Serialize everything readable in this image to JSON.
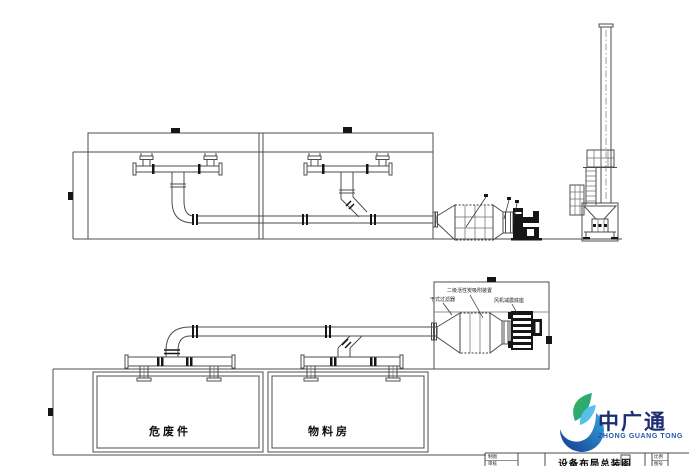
{
  "labels": {
    "room_left": "危废件",
    "room_right": "物料房",
    "plan_filter": "干式过滤器",
    "plan_carbon": "二级活性炭吸附装置",
    "plan_fan_base": "风机减震底座"
  },
  "title_block": {
    "drawing_title": "设备布局总装图",
    "cell_drafter": "制图",
    "cell_checker": "审核",
    "cell_scale": "比例",
    "cell_number": "图号"
  },
  "logo": {
    "name_cn": "中广通",
    "name_en": "ZHONG GUANG TONG"
  },
  "colors": {
    "cad_line": "#4d4d4d",
    "cad_dark": "#161616",
    "logo_navy": "#1c2d72",
    "logo_blue": "#2456a8",
    "logo_cyan": "#35a8e0",
    "logo_green": "#3fae49"
  }
}
